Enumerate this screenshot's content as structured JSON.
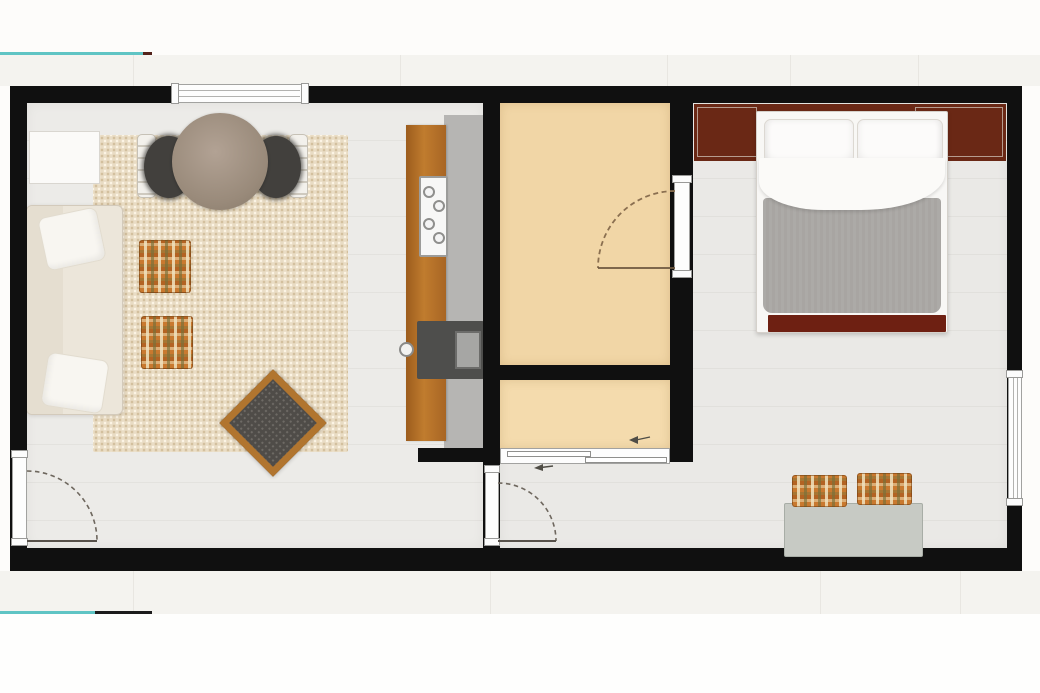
{
  "scene": {
    "type": "floor-plan",
    "view": "top-down-2d-render",
    "text_labels": [],
    "notes": "One-bedroom apartment plan: open living/kitchen area on the left, bathroom and closet in the middle, bedroom on the right."
  },
  "palette": {
    "background": "#fdfcfa",
    "outer_band": "#f4f3ef",
    "teal_accent": "#5fc4c4",
    "wall": "#101010",
    "living_floor": "#ecebe8",
    "bedroom_floor": "#eae9e6",
    "bathroom_floor": "#f1d6a6",
    "closet_floor": "#f4dbad",
    "rug": "#e9dcc4",
    "wood_counter": "#b06f26",
    "counter_top": "#b6b5b3",
    "sink": "#4e4e4c",
    "wardrobe_headboard": "#6a2815",
    "bed_blanket": "#a8a5a2",
    "bed_footboard": "#6e2012",
    "bench": "#c7cac4",
    "plaid_accent": "#c9792f",
    "sofa": "#ece6da",
    "dining_table": "#9a8b7b",
    "coffee_table": "#4f4c48",
    "coffee_table_frame": "#b1752f"
  },
  "rooms": [
    {
      "id": "living-room",
      "floor": "light wood",
      "furniture": [
        "cream sofa with two white pillows",
        "beige area rug",
        "round wooden dining table",
        "two dark dining chairs with white frames",
        "two plaid ottomans",
        "charcoal coffee table rotated 45 degrees",
        "white cabinet",
        "kitchen counter run with stove and sink"
      ]
    },
    {
      "id": "bathroom",
      "floor": "beige",
      "furniture": []
    },
    {
      "id": "closet",
      "floor": "beige",
      "furniture": [
        "sliding door"
      ]
    },
    {
      "id": "bedroom",
      "floor": "light gray",
      "furniture": [
        "double bed with two pillows, white duvet and gray blanket",
        "dark brown headboard wardrobe panels",
        "gray bench with two plaid cushions"
      ]
    }
  ],
  "openings": {
    "windows": [
      {
        "wall": "top",
        "over": "living-room"
      },
      {
        "wall": "right",
        "over": "bedroom"
      }
    ],
    "doors": [
      {
        "type": "swing",
        "location": "left exterior wall into living room"
      },
      {
        "type": "swing",
        "location": "living room to bedroom hallway"
      },
      {
        "type": "swing",
        "location": "bathroom entry"
      },
      {
        "type": "sliding",
        "location": "closet to hallway"
      }
    ]
  },
  "accents": {
    "teal_line_top": {
      "color": "#5fc4c4",
      "tip_color": "#52221a"
    },
    "teal_line_bottom": {
      "color": "#5fc4c4",
      "tip_color": "#1c1c1c"
    }
  }
}
